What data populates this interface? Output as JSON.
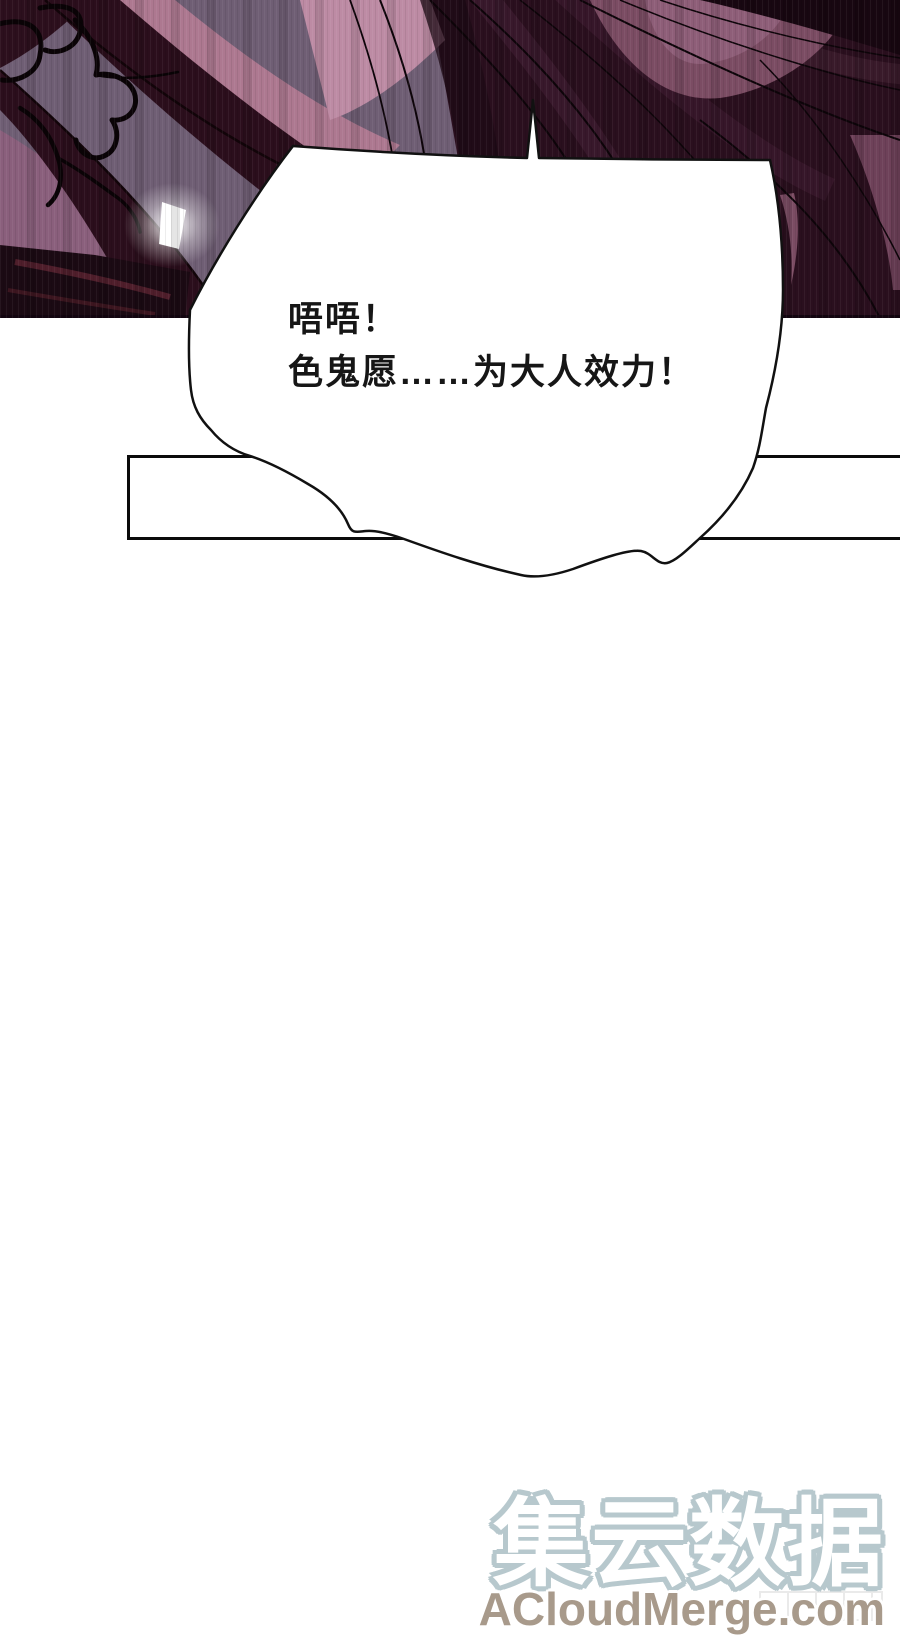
{
  "comic": {
    "speech_bubble": {
      "line1": "唔唔！",
      "line2": "色鬼愿……为大人效力！"
    }
  },
  "watermark": {
    "site_name": "集云数据",
    "site_url": "ACloudMerge.com"
  },
  "colors": {
    "page_bg": "#ffffff",
    "art_base": "#2a0f1e",
    "art_lavender": "#6f5e74",
    "art_pink_band": "#ad7890",
    "art_pink_bright": "#bd8ba4",
    "art_mauve_highlight": "#7b4c63",
    "art_dark_band": "#2b0e1c",
    "art_red_streak": "#4f1e2b",
    "line_black": "#0d0409",
    "bubble_fill": "#ffffff",
    "bubble_stroke": "#111111",
    "frame_stroke": "#0b0b0b",
    "watermark_outline": "#b7c8cd",
    "watermark_url_color": "#a89a8b"
  }
}
